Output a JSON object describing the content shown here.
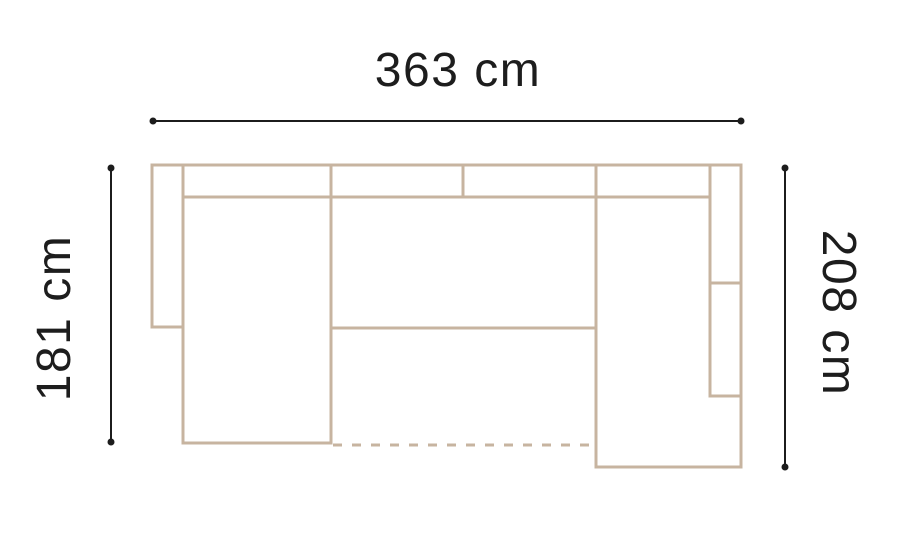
{
  "page": {
    "background": "#ffffff",
    "description": "Top-view floor-plan diagram of a U-shaped corner sofa with three dimension lines"
  },
  "labels": {
    "width_top": "363 cm",
    "depth_left": "181 cm",
    "depth_right": "208 cm"
  },
  "colors": {
    "sofa_outline": "#c7b4a0",
    "dimension_line": "#1c1c1c",
    "text": "#1d1d1d"
  },
  "diagram": {
    "canvas": {
      "width": 908,
      "height": 536
    },
    "sofa": {
      "stroke_width": 3,
      "dash_pattern": "9 10",
      "segments": [
        {
          "name": "sofa-top-edge",
          "x1": 152,
          "y1": 165,
          "x2": 741,
          "y2": 165
        },
        {
          "name": "left-armrest-outer-edge",
          "x1": 152,
          "y1": 165,
          "x2": 152,
          "y2": 327
        },
        {
          "name": "left-armrest-bottom-edge",
          "x1": 152,
          "y1": 327,
          "x2": 183,
          "y2": 327
        },
        {
          "name": "chaise-left-edge",
          "x1": 183,
          "y1": 165,
          "x2": 183,
          "y2": 443
        },
        {
          "name": "chaise-bottom-edge",
          "x1": 183,
          "y1": 443,
          "x2": 331,
          "y2": 443
        },
        {
          "name": "chaise-right-edge",
          "x1": 331,
          "y1": 165,
          "x2": 331,
          "y2": 443
        },
        {
          "name": "backrest-inner-line",
          "x1": 183,
          "y1": 197,
          "x2": 710,
          "y2": 197
        },
        {
          "name": "backrest-divider",
          "x1": 463,
          "y1": 165,
          "x2": 463,
          "y2": 197
        },
        {
          "name": "middle-seat-front-edge",
          "x1": 331,
          "y1": 328,
          "x2": 596,
          "y2": 328
        },
        {
          "name": "right-section-left-edge",
          "x1": 596,
          "y1": 165,
          "x2": 596,
          "y2": 467
        },
        {
          "name": "right-section-bottom-edge",
          "x1": 596,
          "y1": 467,
          "x2": 741,
          "y2": 467
        },
        {
          "name": "sofa-right-edge",
          "x1": 741,
          "y1": 165,
          "x2": 741,
          "y2": 467
        },
        {
          "name": "right-armrest-inner-edge",
          "x1": 710,
          "y1": 165,
          "x2": 710,
          "y2": 396
        },
        {
          "name": "right-armrest-divider-top",
          "x1": 710,
          "y1": 283,
          "x2": 741,
          "y2": 283
        },
        {
          "name": "right-armrest-divider-bottom",
          "x1": 710,
          "y1": 396,
          "x2": 741,
          "y2": 396
        }
      ],
      "dashed_segments": [
        {
          "name": "pullout-bed-dashed-edge",
          "x1": 333,
          "y1": 445,
          "x2": 594,
          "y2": 445
        }
      ]
    },
    "dimension_lines": {
      "stroke_width": 2,
      "dot_radius": 3.5,
      "lines": [
        {
          "name": "width-dimension-line",
          "x1": 153,
          "y1": 121,
          "x2": 741,
          "y2": 121
        },
        {
          "name": "left-depth-dimension-line",
          "x1": 111,
          "y1": 168,
          "x2": 111,
          "y2": 442
        },
        {
          "name": "right-depth-dimension-line",
          "x1": 785,
          "y1": 168,
          "x2": 785,
          "y2": 467
        }
      ]
    }
  }
}
